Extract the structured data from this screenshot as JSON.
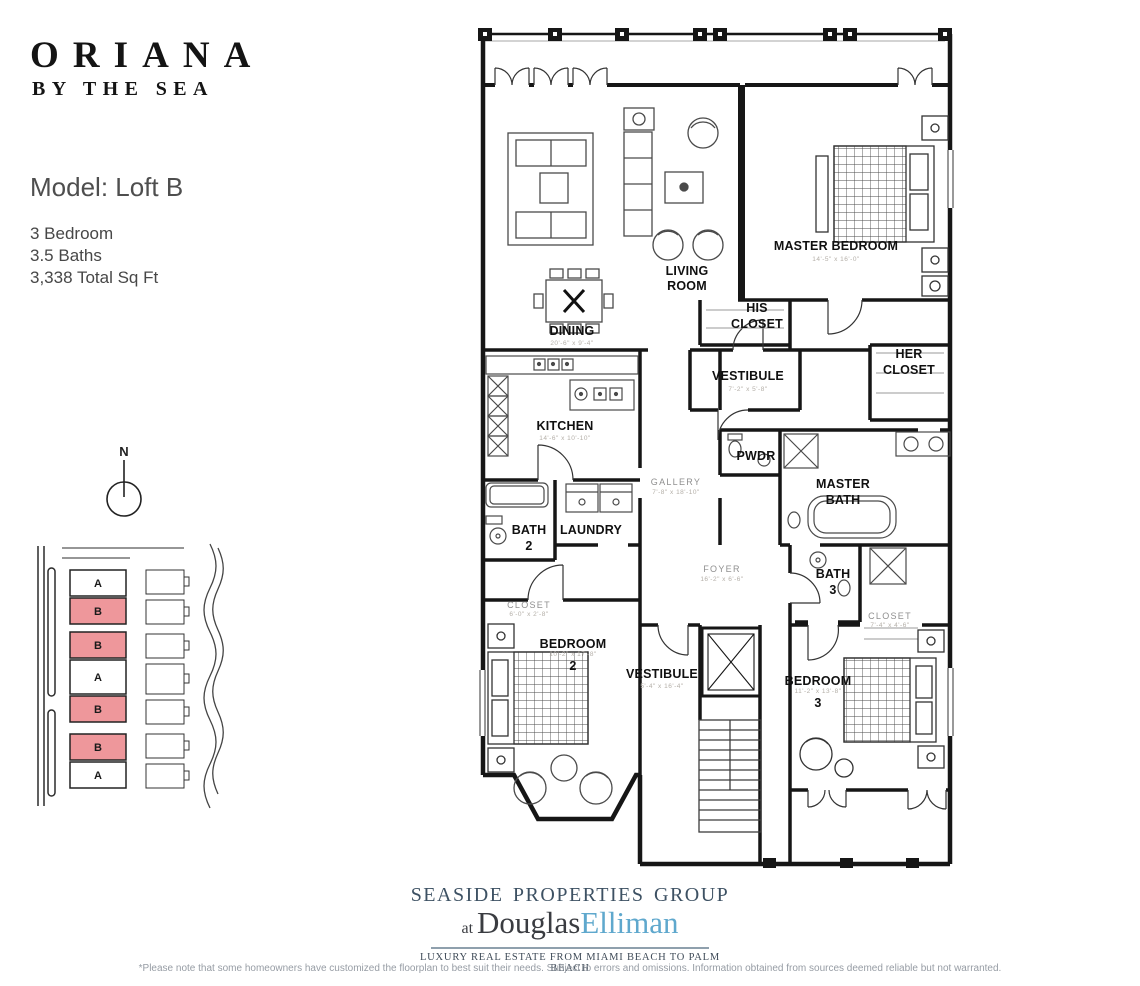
{
  "brand": {
    "title": "ORIANA",
    "subtitle": "BY THE SEA"
  },
  "model": {
    "title": "Model: Loft B",
    "spec1": "3 Bedroom",
    "spec2": "3.5 Baths",
    "spec3": "3,338 Total Sq Ft"
  },
  "compass": {
    "label": "N"
  },
  "siteplan": {
    "units": [
      "A",
      "B",
      "B",
      "A",
      "B",
      "B",
      "A"
    ],
    "unit_fills": [
      "#ffffff",
      "#ee979b",
      "#ee979b",
      "#ffffff",
      "#ee979b",
      "#ee979b",
      "#ffffff"
    ],
    "highlight_color": "#ee979b"
  },
  "floorplan": {
    "rooms": {
      "living": {
        "l1": "LIVING",
        "l2": "ROOM"
      },
      "dining": {
        "label": "DINING",
        "dim": "20'-6\" x 9'-4\""
      },
      "kitchen": {
        "label": "KITCHEN",
        "dim": "14'-6\" x 10'-10\""
      },
      "master_bedroom": {
        "label": "MASTER BEDROOM",
        "dim": "14'-5\" x 16'-0\""
      },
      "his_closet": {
        "l1": "HIS",
        "l2": "CLOSET"
      },
      "her_closet": {
        "l1": "HER",
        "l2": "CLOSET"
      },
      "vestibule_upper": {
        "label": "VESTIBULE",
        "dim": "7'-2\" x 5'-8\""
      },
      "gallery": {
        "label": "GALLERY",
        "dim": "7'-8\" x 18'-10\""
      },
      "pwdr": {
        "label": "PWDR"
      },
      "master_bath": {
        "l1": "MASTER",
        "l2": "BATH"
      },
      "bath_2": {
        "l1": "BATH",
        "l2": "2"
      },
      "laundry": {
        "label": "LAUNDRY"
      },
      "foyer": {
        "label": "FOYER",
        "dim": "16'-2\" x 6'-6\""
      },
      "bath_3": {
        "l1": "BATH",
        "l2": "3"
      },
      "closet_bed3": {
        "label": "CLOSET",
        "dim": "7'-4\" x 4'-6\""
      },
      "closet_bed2": {
        "label": "CLOSET",
        "dim": "6'-0\" x 2'-8\""
      },
      "bedroom_2": {
        "l1": "BEDROOM",
        "l2": "2",
        "dim": "10'-2\" x 17'-8\""
      },
      "vestibule_lower": {
        "label": "VESTIBULE",
        "dim": "5'-4\" x 16'-4\""
      },
      "bedroom_3": {
        "l1": "BEDROOM",
        "l2": "3",
        "dim": "11'-2\" x 13'-8\""
      }
    }
  },
  "logo": {
    "line1": "SEASIDE PROPERTIES GROUP",
    "at": "at ",
    "name1": "Douglas",
    "name2": "Elliman",
    "tagline": "LUXURY REAL ESTATE FROM MIAMI BEACH TO PALM BEACH",
    "accent": "#5fa8cd"
  },
  "footnote": "*Please note that some homeowners have customized the floorplan to best suit their needs. Subject to errors and omissions. Information obtained from sources deemed reliable but not warranted."
}
